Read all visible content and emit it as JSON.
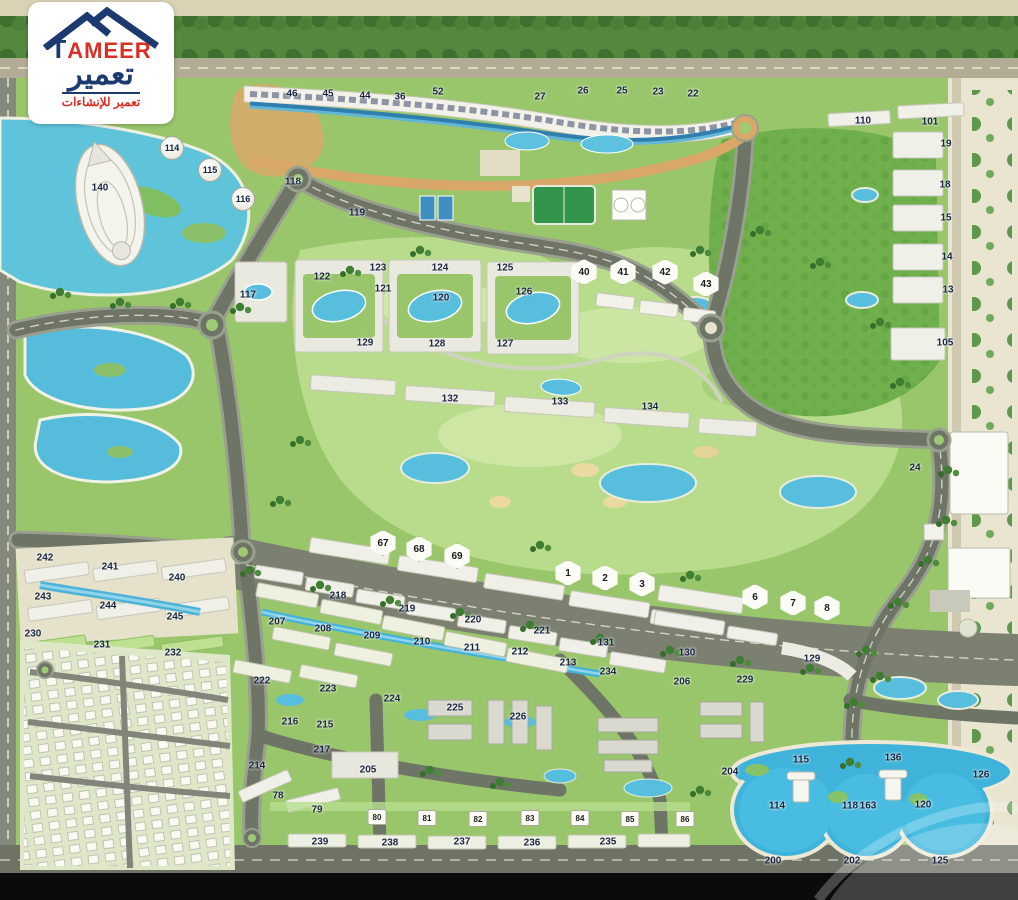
{
  "logo": {
    "brand_t": "T",
    "brand_rest": "AMEER",
    "brand_arabic": "تعمير",
    "tagline_arabic": "تعمير للإنشاءات"
  },
  "palette": {
    "brand_navy": "#1d3a70",
    "brand_red": "#d93025",
    "grass": "#9ac66b",
    "golf": "#b9dc8c",
    "water": "#4db6da",
    "road": "#6e7466",
    "sand": "#e9e5d0"
  },
  "map": {
    "labels": [
      {
        "n": "46",
        "x": 292,
        "y": 94
      },
      {
        "n": "45",
        "x": 328,
        "y": 94
      },
      {
        "n": "44",
        "x": 365,
        "y": 96
      },
      {
        "n": "36",
        "x": 400,
        "y": 97
      },
      {
        "n": "52",
        "x": 438,
        "y": 92
      },
      {
        "n": "27",
        "x": 540,
        "y": 97
      },
      {
        "n": "26",
        "x": 583,
        "y": 91
      },
      {
        "n": "25",
        "x": 622,
        "y": 91
      },
      {
        "n": "23",
        "x": 658,
        "y": 92
      },
      {
        "n": "22",
        "x": 693,
        "y": 94
      },
      {
        "n": "140",
        "x": 100,
        "y": 188
      },
      {
        "n": "118",
        "x": 293,
        "y": 182
      },
      {
        "n": "119",
        "x": 357,
        "y": 213
      },
      {
        "n": "117",
        "x": 248,
        "y": 295
      },
      {
        "n": "122",
        "x": 322,
        "y": 277
      },
      {
        "n": "123",
        "x": 378,
        "y": 268
      },
      {
        "n": "124",
        "x": 440,
        "y": 268
      },
      {
        "n": "125",
        "x": 505,
        "y": 268
      },
      {
        "n": "121",
        "x": 383,
        "y": 289
      },
      {
        "n": "120",
        "x": 441,
        "y": 298
      },
      {
        "n": "126",
        "x": 524,
        "y": 292
      },
      {
        "n": "129",
        "x": 365,
        "y": 343
      },
      {
        "n": "128",
        "x": 437,
        "y": 344
      },
      {
        "n": "127",
        "x": 505,
        "y": 344
      },
      {
        "n": "132",
        "x": 450,
        "y": 399
      },
      {
        "n": "133",
        "x": 560,
        "y": 402
      },
      {
        "n": "134",
        "x": 650,
        "y": 407
      },
      {
        "n": "110",
        "x": 863,
        "y": 121
      },
      {
        "n": "101",
        "x": 930,
        "y": 122
      },
      {
        "n": "19",
        "x": 946,
        "y": 144
      },
      {
        "n": "18",
        "x": 945,
        "y": 185
      },
      {
        "n": "15",
        "x": 946,
        "y": 218
      },
      {
        "n": "14",
        "x": 947,
        "y": 257
      },
      {
        "n": "13",
        "x": 948,
        "y": 290
      },
      {
        "n": "105",
        "x": 945,
        "y": 343
      },
      {
        "n": "24",
        "x": 915,
        "y": 468
      },
      {
        "n": "218",
        "x": 338,
        "y": 596
      },
      {
        "n": "219",
        "x": 407,
        "y": 609
      },
      {
        "n": "220",
        "x": 473,
        "y": 620
      },
      {
        "n": "221",
        "x": 542,
        "y": 631
      },
      {
        "n": "131",
        "x": 606,
        "y": 643
      },
      {
        "n": "207",
        "x": 277,
        "y": 622
      },
      {
        "n": "208",
        "x": 323,
        "y": 629
      },
      {
        "n": "209",
        "x": 372,
        "y": 636
      },
      {
        "n": "210",
        "x": 422,
        "y": 642
      },
      {
        "n": "211",
        "x": 472,
        "y": 648
      },
      {
        "n": "212",
        "x": 520,
        "y": 652
      },
      {
        "n": "213",
        "x": 568,
        "y": 663
      },
      {
        "n": "234",
        "x": 608,
        "y": 672
      },
      {
        "n": "130",
        "x": 687,
        "y": 653
      },
      {
        "n": "206",
        "x": 682,
        "y": 682
      },
      {
        "n": "229",
        "x": 745,
        "y": 680
      },
      {
        "n": "129",
        "x": 812,
        "y": 659
      },
      {
        "n": "242",
        "x": 45,
        "y": 558
      },
      {
        "n": "241",
        "x": 110,
        "y": 567
      },
      {
        "n": "240",
        "x": 177,
        "y": 578
      },
      {
        "n": "243",
        "x": 43,
        "y": 597
      },
      {
        "n": "244",
        "x": 108,
        "y": 606
      },
      {
        "n": "245",
        "x": 175,
        "y": 617
      },
      {
        "n": "230",
        "x": 33,
        "y": 634
      },
      {
        "n": "231",
        "x": 102,
        "y": 645
      },
      {
        "n": "232",
        "x": 173,
        "y": 653
      },
      {
        "n": "222",
        "x": 262,
        "y": 681
      },
      {
        "n": "223",
        "x": 328,
        "y": 689
      },
      {
        "n": "224",
        "x": 392,
        "y": 699
      },
      {
        "n": "225",
        "x": 455,
        "y": 708
      },
      {
        "n": "226",
        "x": 518,
        "y": 717
      },
      {
        "n": "216",
        "x": 290,
        "y": 722
      },
      {
        "n": "215",
        "x": 325,
        "y": 725
      },
      {
        "n": "217",
        "x": 322,
        "y": 750
      },
      {
        "n": "214",
        "x": 257,
        "y": 766
      },
      {
        "n": "205",
        "x": 368,
        "y": 770
      },
      {
        "n": "78",
        "x": 278,
        "y": 796
      },
      {
        "n": "79",
        "x": 317,
        "y": 810
      },
      {
        "n": "239",
        "x": 320,
        "y": 842
      },
      {
        "n": "238",
        "x": 390,
        "y": 843
      },
      {
        "n": "237",
        "x": 462,
        "y": 842
      },
      {
        "n": "236",
        "x": 532,
        "y": 843
      },
      {
        "n": "235",
        "x": 608,
        "y": 842
      },
      {
        "n": "204",
        "x": 730,
        "y": 772
      },
      {
        "n": "115",
        "x": 801,
        "y": 760
      },
      {
        "n": "136",
        "x": 893,
        "y": 758
      },
      {
        "n": "126",
        "x": 981,
        "y": 775
      },
      {
        "n": "114",
        "x": 777,
        "y": 806
      },
      {
        "n": "118",
        "x": 850,
        "y": 806
      },
      {
        "n": "163",
        "x": 868,
        "y": 806
      },
      {
        "n": "120",
        "x": 923,
        "y": 805
      },
      {
        "n": "200",
        "x": 773,
        "y": 861
      },
      {
        "n": "202",
        "x": 852,
        "y": 861
      },
      {
        "n": "125",
        "x": 940,
        "y": 861
      }
    ],
    "villas": [
      {
        "n": "40",
        "x": 584,
        "y": 272
      },
      {
        "n": "41",
        "x": 623,
        "y": 272
      },
      {
        "n": "42",
        "x": 665,
        "y": 272
      },
      {
        "n": "43",
        "x": 706,
        "y": 284
      },
      {
        "n": "67",
        "x": 383,
        "y": 543
      },
      {
        "n": "68",
        "x": 419,
        "y": 549
      },
      {
        "n": "69",
        "x": 457,
        "y": 556
      },
      {
        "n": "1",
        "x": 568,
        "y": 573
      },
      {
        "n": "2",
        "x": 605,
        "y": 578
      },
      {
        "n": "3",
        "x": 642,
        "y": 584
      },
      {
        "n": "6",
        "x": 755,
        "y": 597
      },
      {
        "n": "7",
        "x": 793,
        "y": 603
      },
      {
        "n": "8",
        "x": 827,
        "y": 608
      }
    ],
    "houses": [
      {
        "n": "80",
        "x": 377,
        "y": 817
      },
      {
        "n": "81",
        "x": 427,
        "y": 818
      },
      {
        "n": "82",
        "x": 478,
        "y": 819
      },
      {
        "n": "83",
        "x": 530,
        "y": 818
      },
      {
        "n": "84",
        "x": 580,
        "y": 818
      },
      {
        "n": "85",
        "x": 630,
        "y": 819
      },
      {
        "n": "86",
        "x": 685,
        "y": 819
      }
    ],
    "domes": [
      {
        "n": "114",
        "x": 172,
        "y": 148
      },
      {
        "n": "115",
        "x": 210,
        "y": 170
      },
      {
        "n": "116",
        "x": 243,
        "y": 199
      }
    ]
  }
}
